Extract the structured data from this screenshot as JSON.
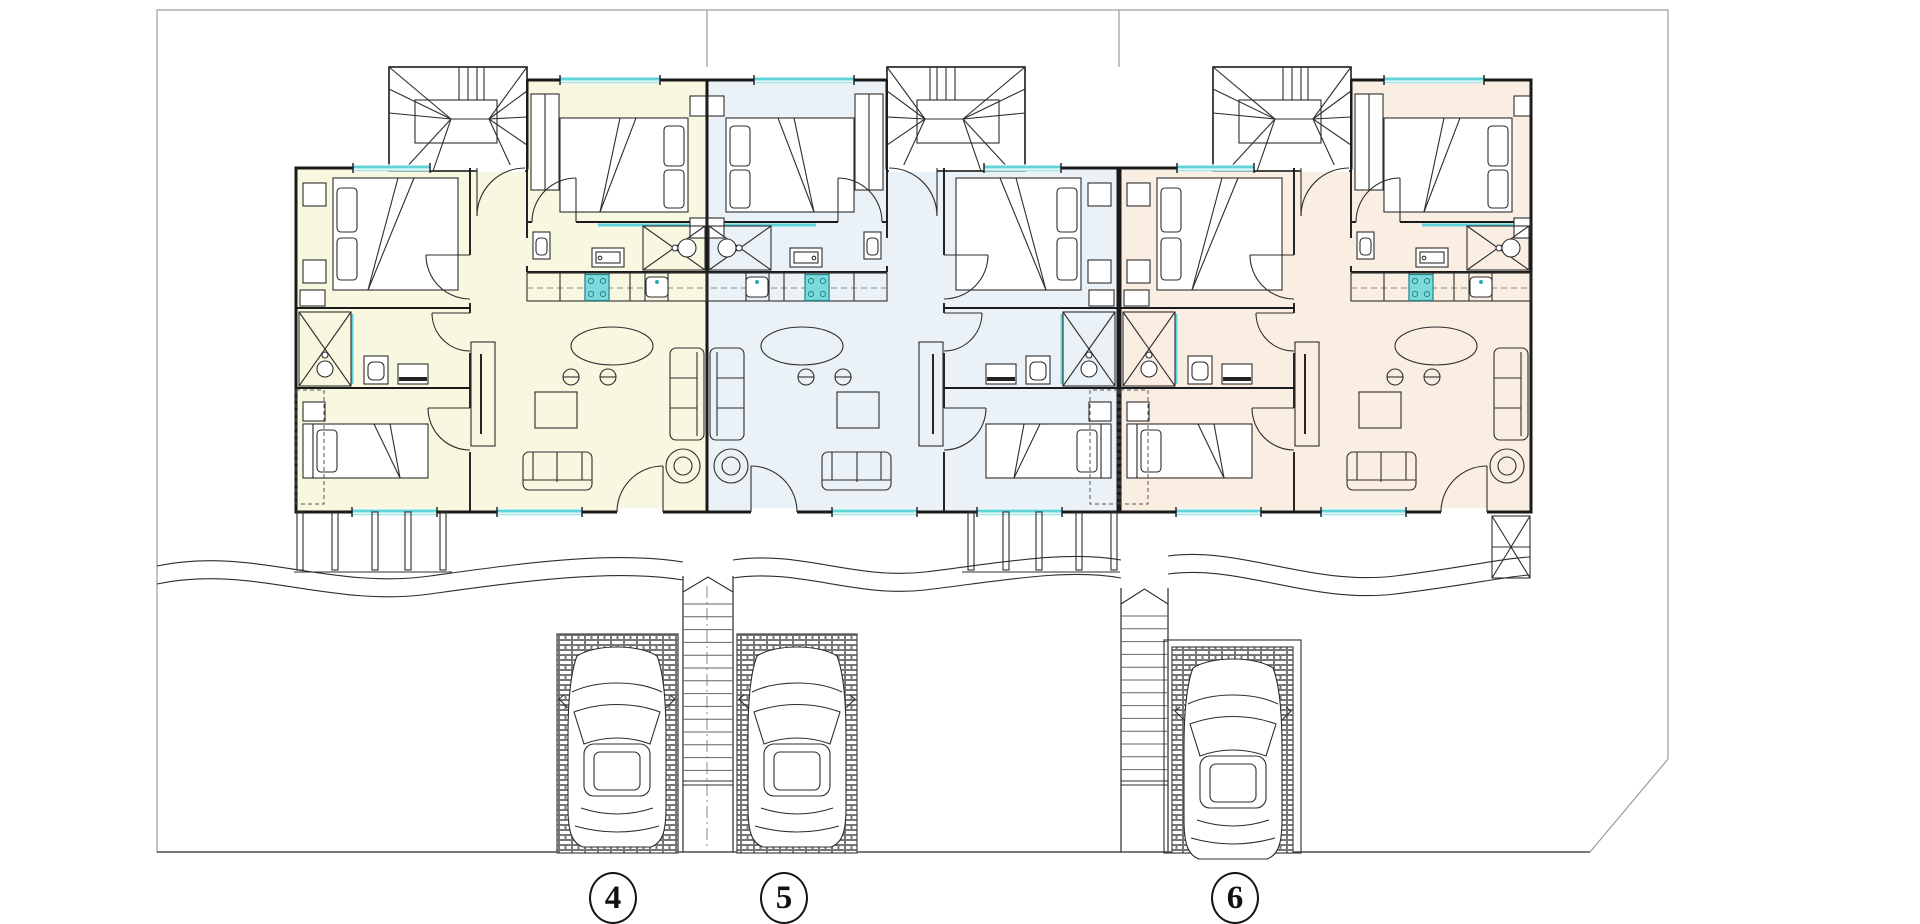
{
  "document": {
    "type": "architectural site / floor plan",
    "background": "#ffffff"
  },
  "plot_labels": [
    {
      "label": "4"
    },
    {
      "label": "5"
    },
    {
      "label": "6"
    }
  ],
  "units": [
    {
      "name": "unit-4",
      "plot": "4",
      "floor_fill": "#f8f7e0",
      "mirrored": false
    },
    {
      "name": "unit-5",
      "plot": "5",
      "floor_fill": "#eaf2f7",
      "mirrored": true
    },
    {
      "name": "unit-6",
      "plot": "6",
      "floor_fill": "#faeee3",
      "mirrored": false
    }
  ],
  "site": {
    "parking_spaces": [
      {
        "plot": "4"
      },
      {
        "plot": "5"
      },
      {
        "plot": "6"
      }
    ],
    "cars": 3,
    "external_stairs": 2,
    "winder_stairs": 3,
    "walkway": "wavy double line"
  },
  "colors": {
    "wall": "#1a1a1a",
    "furniture": "#2d2d2d",
    "window_glass": "#5fd4db",
    "fixture_fill": "#7edada",
    "fixture_stroke": "#1f8a92",
    "boundary": "#9c9c9c",
    "ground_line": "#555555"
  },
  "icons": [
    {
      "name": "car-top-view-icon"
    },
    {
      "name": "winder-stair-icon"
    },
    {
      "name": "outdoor-stair-icon"
    },
    {
      "name": "shower-icon"
    },
    {
      "name": "double-bed-icon"
    },
    {
      "name": "single-bed-icon"
    },
    {
      "name": "sofa-icon"
    },
    {
      "name": "dining-table-icon"
    },
    {
      "name": "stove-icon"
    },
    {
      "name": "sink-icon"
    },
    {
      "name": "toilet-icon"
    },
    {
      "name": "brick-paving-icon"
    }
  ]
}
